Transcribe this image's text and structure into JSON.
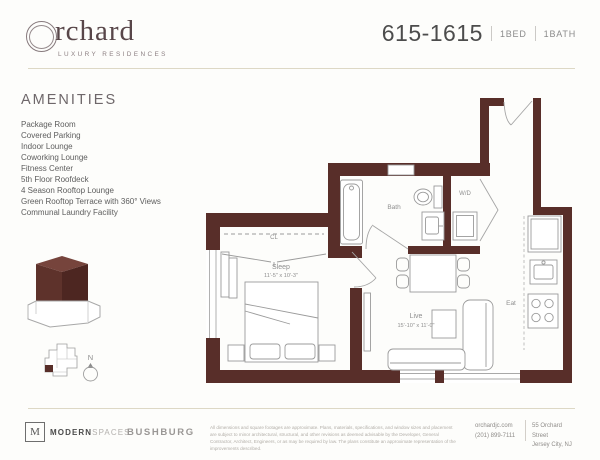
{
  "header": {
    "brand": {
      "initial": "O",
      "wordmark": "rchard",
      "tagline": "LUXURY RESIDENCES"
    },
    "unit": {
      "number": "615-1615",
      "bed": "1BED",
      "bath": "1BATH"
    }
  },
  "amenities": {
    "title": "AMENITIES",
    "items": [
      "Package Room",
      "Covered Parking",
      "Indoor Lounge",
      "Coworking Lounge",
      "Fitness Center",
      "5th Floor Roofdeck",
      "4 Season Rooftop Lounge",
      "Green Rooftop Terrace with 360° Views",
      "Communal Laundry Facility"
    ]
  },
  "floorplan": {
    "rooms": {
      "sleep": {
        "label": "Sleep",
        "dims": "11'-5\" x 10'-3\""
      },
      "live": {
        "label": "Live",
        "dims": "15'-10\" x 11'-0\""
      },
      "bath": "Bath",
      "wd": "W/D",
      "closet": "CL",
      "eat": "Eat"
    },
    "compass": "N"
  },
  "footer": {
    "brokerage_mark": "M",
    "brokerage_bold": "MODERN",
    "brokerage_light": "SPACES",
    "developer": "BUSHBURG",
    "disclaimer": "All dimensions and square footages are approximate. Plans, materials, specifications, and window sizes and placement are subject to minor architectural, structural, and other revisions as deemed advisable by the Developer, General Contractor, Architect, Engineers, or as may be required by law. The plans constitute an approximate representation of the improvements described.",
    "website": "orchardjc.com",
    "phone": "(201) 899-7111",
    "address_line1": "55 Orchard Street",
    "address_line2": "Jersey City, NJ"
  },
  "colors": {
    "wall": "#582e29",
    "tower_top": "#76443c",
    "tower_left": "#5e322b",
    "tower_right": "#4d2621",
    "rule": "#ddd8c5"
  }
}
